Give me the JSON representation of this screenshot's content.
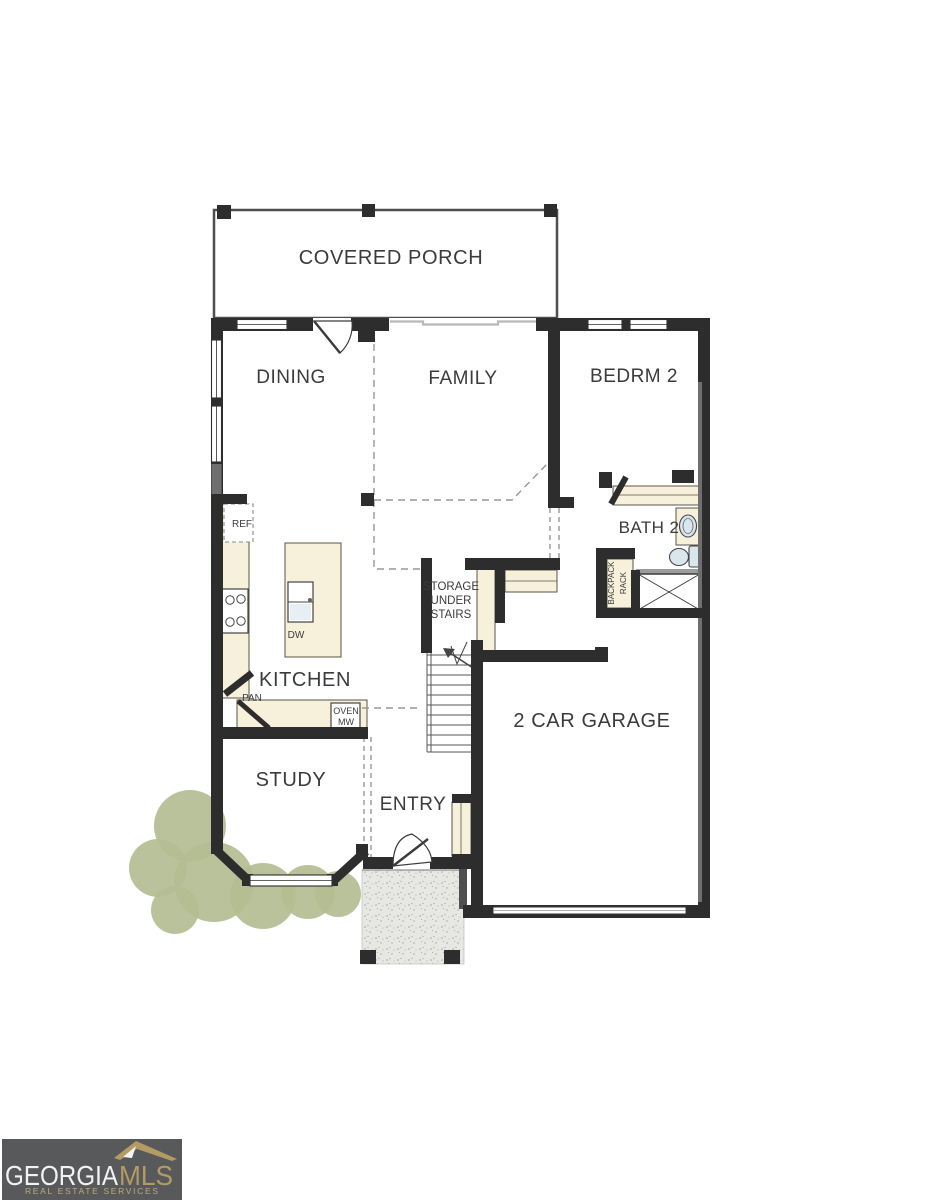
{
  "plan": {
    "rooms": {
      "covered_porch": "COVERED PORCH",
      "dining": "DINING",
      "family": "FAMILY",
      "bedrm2": "BEDRM 2",
      "bath2": "BATH 2",
      "kitchen": "KITCHEN",
      "study": "STUDY",
      "entry": "ENTRY",
      "garage": "2 CAR GARAGE"
    },
    "storage": {
      "line1": "STORAGE",
      "line2": "UNDER",
      "line3": "STAIRS"
    },
    "backpack_rack": {
      "line1": "BACKPACK",
      "line2": "RACK"
    },
    "labels": {
      "refrigerator": "REF",
      "dishwasher": "DW",
      "pantry": "PAN",
      "oven": "OVEN",
      "microwave": "MW"
    }
  },
  "logo": {
    "brand": "GEORGIA",
    "brand_suffix": "MLS",
    "tagline": "REAL ESTATE SERVICES"
  },
  "colors": {
    "wall": "#2d2d2d",
    "wall_gray": "#6f6f6f",
    "cabinet": "#f7f0da",
    "cabinet_stroke": "#5a5647",
    "fixture": "#d9e6ee",
    "landscape": "#b4bd92",
    "stoop": "#e7e7e4",
    "stoop_dot": "#a3a3a0",
    "dash": "#979797",
    "label": "#3b3b3b",
    "thin_open": "#b8b8b8",
    "logo_bg": "#58595b",
    "logo_gold": "#b49a63",
    "logo_white": "#f2f2f2"
  }
}
